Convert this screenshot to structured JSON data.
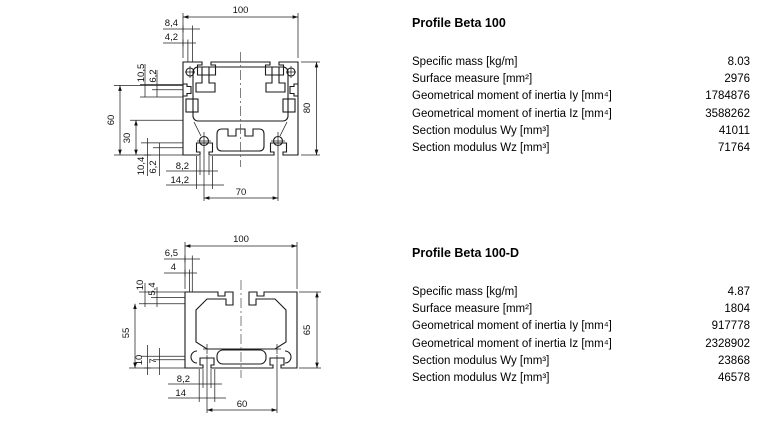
{
  "document": {
    "background": "#ffffff",
    "text_color": "#000000",
    "drawing_line_color": "#1a1a1a"
  },
  "drawings": [
    {
      "dims": {
        "overall_width": "100",
        "top_a": "8,4",
        "top_b": "4,2",
        "left_a": "10,5",
        "left_b": "6,2",
        "left_height": "60",
        "left_c": "30",
        "bottom_left_a": "10,4",
        "bottom_left_b": "6,2",
        "bottom_a": "8,2",
        "bottom_b": "14,2",
        "bottom_width": "70",
        "overall_height": "80"
      }
    },
    {
      "dims": {
        "overall_width": "100",
        "top_a": "6,5",
        "top_b": "4",
        "left_a": "10",
        "left_b": "5,4",
        "left_height": "55",
        "bottom_left_a": "10",
        "bottom_left_b": "7",
        "bottom_a": "8,2",
        "bottom_b": "14",
        "bottom_width": "60",
        "overall_height": "65"
      }
    }
  ],
  "tables": [
    {
      "title": "Profile Beta 100",
      "rows": [
        {
          "label": "Specific mass [kg/m]",
          "value": "8.03"
        },
        {
          "label": "Surface measure [mm²]",
          "value": "2976"
        },
        {
          "label": "Geometrical moment of inertia Iy [mm⁴]",
          "value": "1784876"
        },
        {
          "label": "Geometrical moment of inertia Iz [mm⁴]",
          "value": "3588262"
        },
        {
          "label": "Section modulus Wy [mm³]",
          "value": "41011"
        },
        {
          "label": "Section modulus Wz [mm³]",
          "value": "71764"
        }
      ]
    },
    {
      "title": "Profile Beta 100-D",
      "rows": [
        {
          "label": "Specific mass [kg/m]",
          "value": "4.87"
        },
        {
          "label": "Surface measure [mm²]",
          "value": "1804"
        },
        {
          "label": "Geometrical moment of inertia Iy [mm⁴]",
          "value": "917778"
        },
        {
          "label": "Geometrical moment of inertia Iz [mm⁴]",
          "value": "2328902"
        },
        {
          "label": "Section modulus Wy [mm³]",
          "value": "23868"
        },
        {
          "label": "Section modulus Wz [mm³]",
          "value": "46578"
        }
      ]
    }
  ]
}
